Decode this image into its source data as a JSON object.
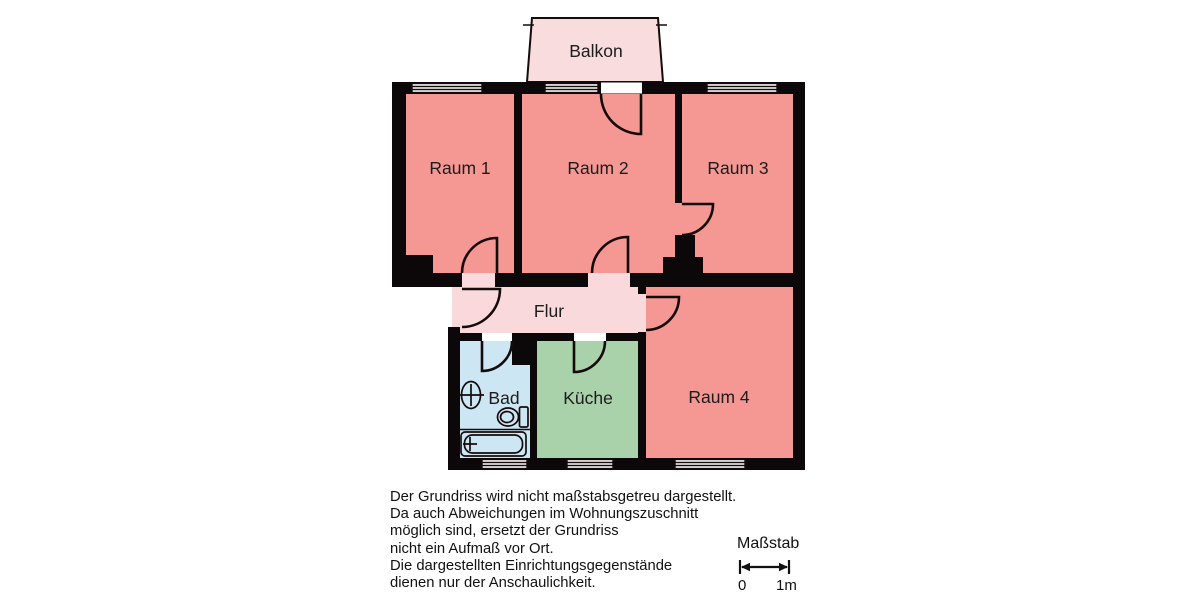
{
  "plan": {
    "rooms": {
      "balkon": "Balkon",
      "raum1": "Raum 1",
      "raum2": "Raum 2",
      "raum3": "Raum 3",
      "raum4": "Raum 4",
      "flur": "Flur",
      "bad": "Bad",
      "kueche": "Küche"
    },
    "colors": {
      "wall": "#0c0809",
      "room": "#f59894",
      "hall": "#f9d9db",
      "balcony": "#f8dcde",
      "bath": "#cde6f4",
      "kitchen": "#a9d2ab",
      "window": "#ffffff",
      "line": "#150b0b"
    }
  },
  "disclaimer": {
    "lines": [
      "Der Grundriss wird nicht maßstabsgetreu dargestellt.",
      "Da auch Abweichungen im Wohnungszuschnitt",
      "möglich sind, ersetzt der Grundriss",
      "nicht ein Aufmaß vor Ort.",
      "Die dargestellten Einrichtungsgegenstände",
      "dienen nur der Anschaulichkeit."
    ]
  },
  "scale": {
    "title": "Maßstab",
    "zero_label": "0",
    "one_label": "1m"
  }
}
